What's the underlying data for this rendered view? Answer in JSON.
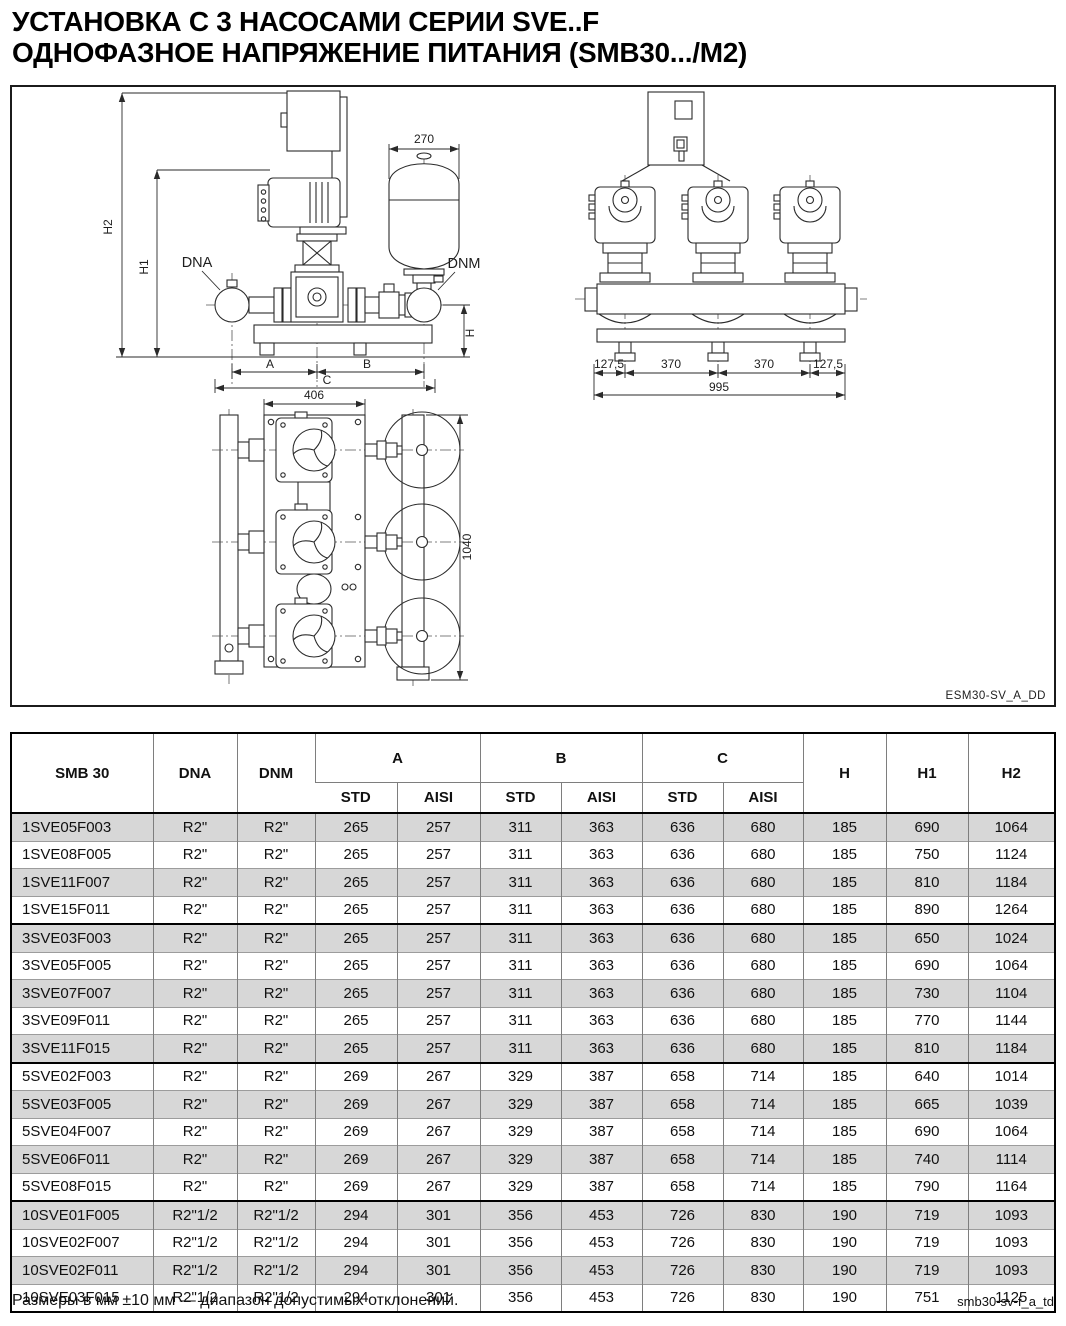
{
  "page": {
    "title_line1": "УСТАНОВКА С 3 НАСОСАМИ СЕРИИ SVE..F",
    "title_line2": "ОДНОФАЗНОЕ НАПРЯЖЕНИЕ ПИТАНИЯ (SMB30.../M2)",
    "footer_note": "Размеры в мм ±10 мм — диапазон допустимых отклонений.",
    "footer_code": "smb30-sv-f_a_td"
  },
  "drawing": {
    "code_label": "ESM30-SV_A_DD",
    "front_view": {
      "h2": "H2",
      "h1": "H1",
      "h": "H",
      "dna": "DNA",
      "dnm": "DNM",
      "tank_diameter": "270",
      "a": "A",
      "b": "B",
      "c": "C"
    },
    "side_view": {
      "edge_left": "127,5",
      "span1": "370",
      "span2": "370",
      "edge_right": "127,5",
      "total": "995"
    },
    "plan_view": {
      "width": "406",
      "depth": "1040"
    }
  },
  "table": {
    "col_model": "SMB 30",
    "col_dna": "DNA",
    "col_dnm": "DNM",
    "col_a": "A",
    "col_b": "B",
    "col_c": "C",
    "col_h": "H",
    "col_h1": "H1",
    "col_h2": "H2",
    "sub_std": "STD",
    "sub_aisi": "AISI",
    "rows": [
      {
        "model": "1SVE05F003",
        "dna": "R2\"",
        "dnm": "R2\"",
        "a_std": "265",
        "a_aisi": "257",
        "b_std": "311",
        "b_aisi": "363",
        "c_std": "636",
        "c_aisi": "680",
        "h": "185",
        "h1": "690",
        "h2": "1064",
        "group_start": false
      },
      {
        "model": "1SVE08F005",
        "dna": "R2\"",
        "dnm": "R2\"",
        "a_std": "265",
        "a_aisi": "257",
        "b_std": "311",
        "b_aisi": "363",
        "c_std": "636",
        "c_aisi": "680",
        "h": "185",
        "h1": "750",
        "h2": "1124",
        "group_start": false
      },
      {
        "model": "1SVE11F007",
        "dna": "R2\"",
        "dnm": "R2\"",
        "a_std": "265",
        "a_aisi": "257",
        "b_std": "311",
        "b_aisi": "363",
        "c_std": "636",
        "c_aisi": "680",
        "h": "185",
        "h1": "810",
        "h2": "1184",
        "group_start": false
      },
      {
        "model": "1SVE15F011",
        "dna": "R2\"",
        "dnm": "R2\"",
        "a_std": "265",
        "a_aisi": "257",
        "b_std": "311",
        "b_aisi": "363",
        "c_std": "636",
        "c_aisi": "680",
        "h": "185",
        "h1": "890",
        "h2": "1264",
        "group_start": false
      },
      {
        "model": "3SVE03F003",
        "dna": "R2\"",
        "dnm": "R2\"",
        "a_std": "265",
        "a_aisi": "257",
        "b_std": "311",
        "b_aisi": "363",
        "c_std": "636",
        "c_aisi": "680",
        "h": "185",
        "h1": "650",
        "h2": "1024",
        "group_start": true
      },
      {
        "model": "3SVE05F005",
        "dna": "R2\"",
        "dnm": "R2\"",
        "a_std": "265",
        "a_aisi": "257",
        "b_std": "311",
        "b_aisi": "363",
        "c_std": "636",
        "c_aisi": "680",
        "h": "185",
        "h1": "690",
        "h2": "1064",
        "group_start": false
      },
      {
        "model": "3SVE07F007",
        "dna": "R2\"",
        "dnm": "R2\"",
        "a_std": "265",
        "a_aisi": "257",
        "b_std": "311",
        "b_aisi": "363",
        "c_std": "636",
        "c_aisi": "680",
        "h": "185",
        "h1": "730",
        "h2": "1104",
        "group_start": false
      },
      {
        "model": "3SVE09F011",
        "dna": "R2\"",
        "dnm": "R2\"",
        "a_std": "265",
        "a_aisi": "257",
        "b_std": "311",
        "b_aisi": "363",
        "c_std": "636",
        "c_aisi": "680",
        "h": "185",
        "h1": "770",
        "h2": "1144",
        "group_start": false
      },
      {
        "model": "3SVE11F015",
        "dna": "R2\"",
        "dnm": "R2\"",
        "a_std": "265",
        "a_aisi": "257",
        "b_std": "311",
        "b_aisi": "363",
        "c_std": "636",
        "c_aisi": "680",
        "h": "185",
        "h1": "810",
        "h2": "1184",
        "group_start": false
      },
      {
        "model": "5SVE02F003",
        "dna": "R2\"",
        "dnm": "R2\"",
        "a_std": "269",
        "a_aisi": "267",
        "b_std": "329",
        "b_aisi": "387",
        "c_std": "658",
        "c_aisi": "714",
        "h": "185",
        "h1": "640",
        "h2": "1014",
        "group_start": true
      },
      {
        "model": "5SVE03F005",
        "dna": "R2\"",
        "dnm": "R2\"",
        "a_std": "269",
        "a_aisi": "267",
        "b_std": "329",
        "b_aisi": "387",
        "c_std": "658",
        "c_aisi": "714",
        "h": "185",
        "h1": "665",
        "h2": "1039",
        "group_start": false
      },
      {
        "model": "5SVE04F007",
        "dna": "R2\"",
        "dnm": "R2\"",
        "a_std": "269",
        "a_aisi": "267",
        "b_std": "329",
        "b_aisi": "387",
        "c_std": "658",
        "c_aisi": "714",
        "h": "185",
        "h1": "690",
        "h2": "1064",
        "group_start": false
      },
      {
        "model": "5SVE06F011",
        "dna": "R2\"",
        "dnm": "R2\"",
        "a_std": "269",
        "a_aisi": "267",
        "b_std": "329",
        "b_aisi": "387",
        "c_std": "658",
        "c_aisi": "714",
        "h": "185",
        "h1": "740",
        "h2": "1114",
        "group_start": false
      },
      {
        "model": "5SVE08F015",
        "dna": "R2\"",
        "dnm": "R2\"",
        "a_std": "269",
        "a_aisi": "267",
        "b_std": "329",
        "b_aisi": "387",
        "c_std": "658",
        "c_aisi": "714",
        "h": "185",
        "h1": "790",
        "h2": "1164",
        "group_start": false
      },
      {
        "model": "10SVE01F005",
        "dna": "R2\"1/2",
        "dnm": "R2\"1/2",
        "a_std": "294",
        "a_aisi": "301",
        "b_std": "356",
        "b_aisi": "453",
        "c_std": "726",
        "c_aisi": "830",
        "h": "190",
        "h1": "719",
        "h2": "1093",
        "group_start": true
      },
      {
        "model": "10SVE02F007",
        "dna": "R2\"1/2",
        "dnm": "R2\"1/2",
        "a_std": "294",
        "a_aisi": "301",
        "b_std": "356",
        "b_aisi": "453",
        "c_std": "726",
        "c_aisi": "830",
        "h": "190",
        "h1": "719",
        "h2": "1093",
        "group_start": false
      },
      {
        "model": "10SVE02F011",
        "dna": "R2\"1/2",
        "dnm": "R2\"1/2",
        "a_std": "294",
        "a_aisi": "301",
        "b_std": "356",
        "b_aisi": "453",
        "c_std": "726",
        "c_aisi": "830",
        "h": "190",
        "h1": "719",
        "h2": "1093",
        "group_start": false
      },
      {
        "model": "10SVE03F015",
        "dna": "R2\"1/2",
        "dnm": "R2\"1/2",
        "a_std": "294",
        "a_aisi": "301",
        "b_std": "356",
        "b_aisi": "453",
        "c_std": "726",
        "c_aisi": "830",
        "h": "190",
        "h1": "751",
        "h2": "1125",
        "group_start": false
      }
    ]
  }
}
